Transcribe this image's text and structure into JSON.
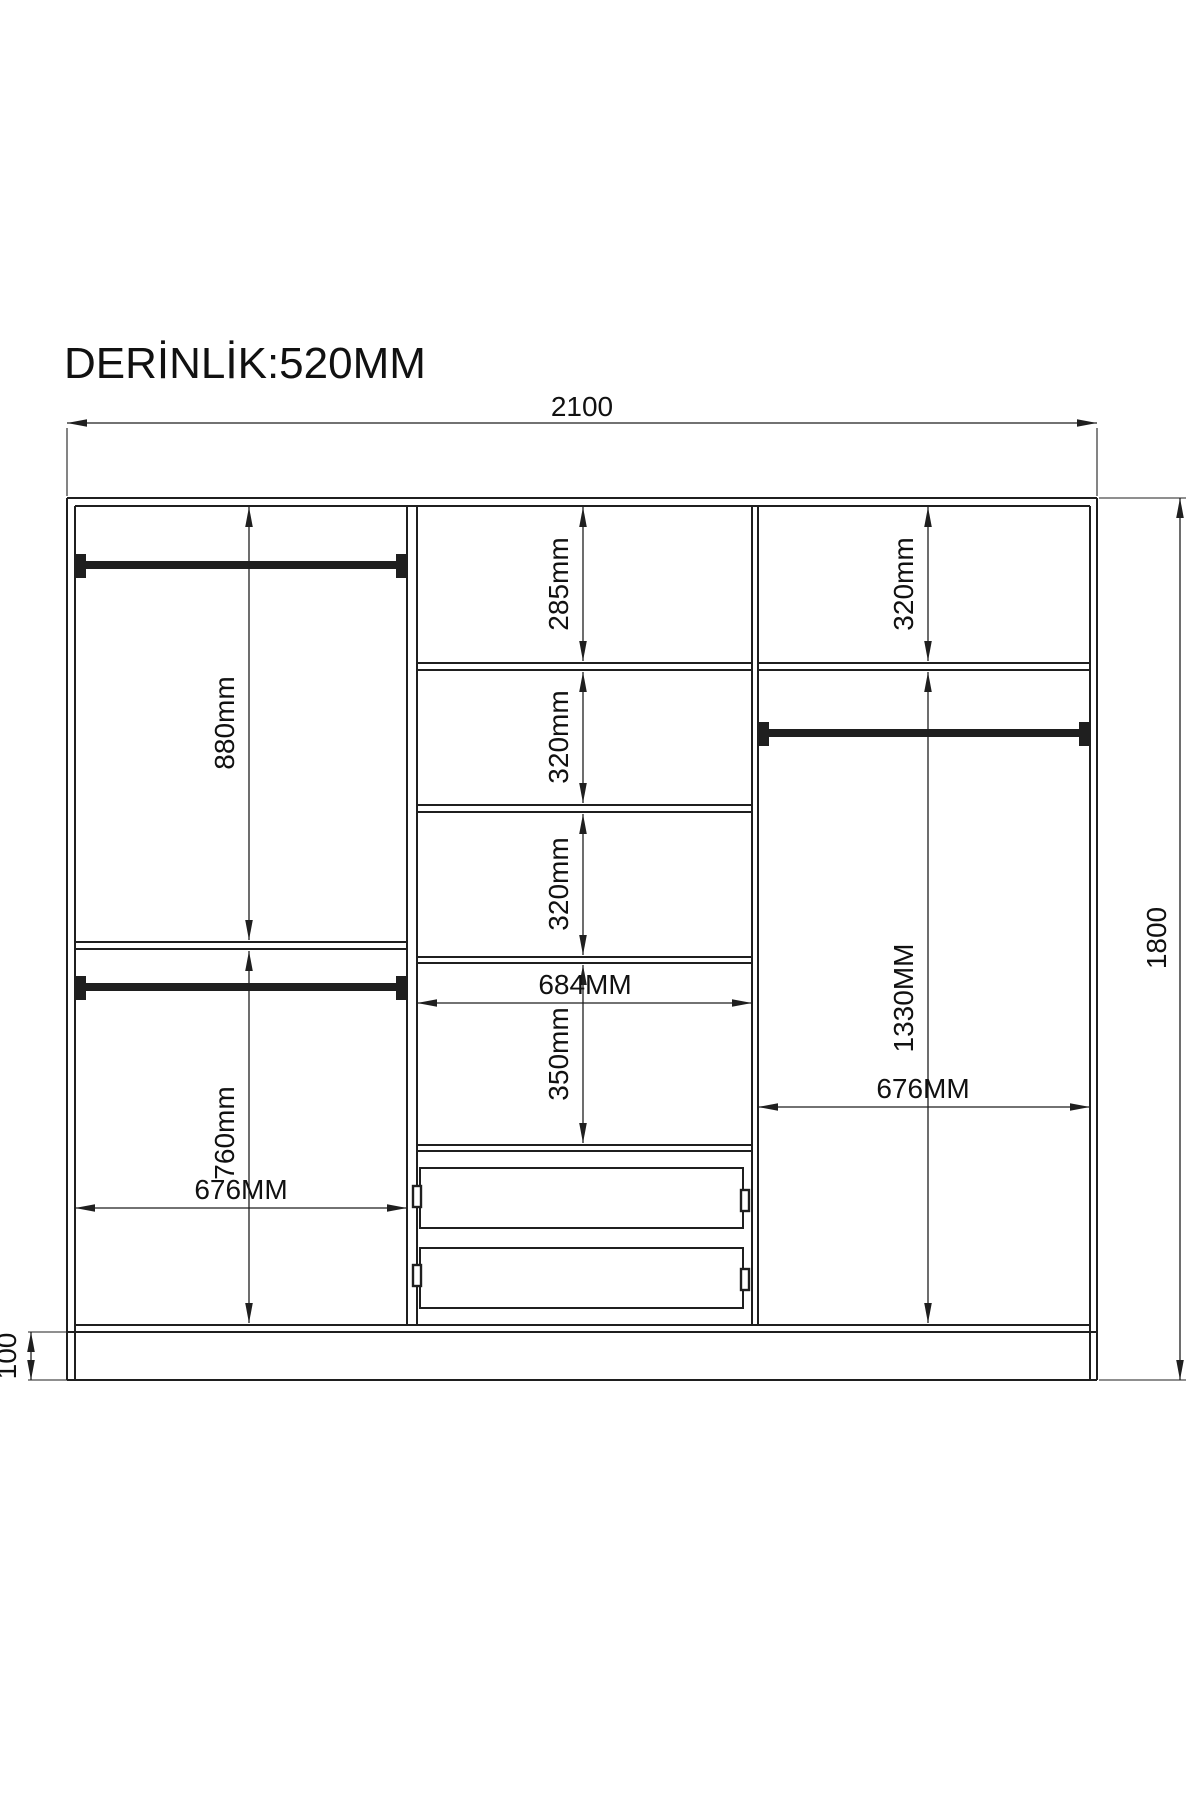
{
  "drawing": {
    "title": "DERİNLİK:520MM",
    "overall": {
      "width": "2100",
      "height": "1800",
      "plinth_height": "100"
    },
    "left_section": {
      "upper_height": "880mm",
      "lower_height": "760mm",
      "width": "676MM"
    },
    "middle_section": {
      "gap1": "285mm",
      "gap2": "320mm",
      "gap3": "320mm",
      "gap4": "350mm",
      "width": "684MM"
    },
    "right_section": {
      "top_gap": "320mm",
      "hang_height": "1330MM",
      "width": "676MM"
    }
  }
}
